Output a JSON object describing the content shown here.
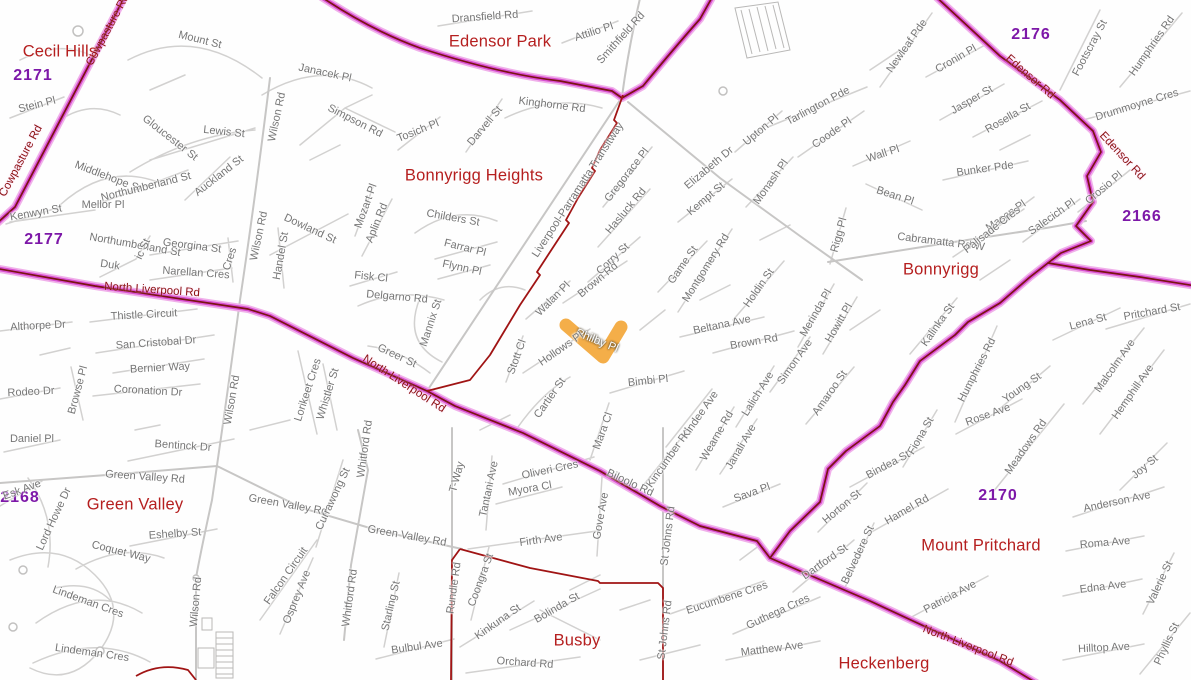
{
  "map": {
    "highlight": {
      "street": "Philby Pl",
      "color": "#f3aa3f"
    },
    "colors": {
      "major_road_halo": "#f0b0ea",
      "major_road": "#d94fd2",
      "major_road_centerline": "#7a1313",
      "boundary_line": "#a01414",
      "minor_road": "#d2d1d0",
      "street_label": "#767676",
      "road_label": "#8b1212",
      "suburb_label": "#b51f1f",
      "postcode_label": "#7d18a8"
    },
    "suburbs": [
      {
        "name": "Cecil Hills",
        "postcode": "2171"
      },
      {
        "name": "Edensor Park",
        "postcode": "2176"
      },
      {
        "name": "Bonnyrigg Heights",
        "postcode": "2177"
      },
      {
        "name": "Bonnyrigg",
        "postcode": "2177"
      },
      {
        "name": "Green Valley",
        "postcode": "2168"
      },
      {
        "name": "Busby",
        "postcode": "2168"
      },
      {
        "name": "Mount Pritchard",
        "postcode": "2170"
      },
      {
        "name": "Heckenberg",
        "postcode": "2168"
      }
    ],
    "labels": [
      [
        "Cecil Hills",
        60,
        52,
        0,
        "u"
      ],
      [
        "Edensor Park",
        500,
        42,
        0,
        "u"
      ],
      [
        "Bonnyrigg Heights",
        474,
        176,
        0,
        "u"
      ],
      [
        "Bonnyrigg",
        941,
        270,
        0,
        "u"
      ],
      [
        "Green Valley",
        135,
        505,
        0,
        "u"
      ],
      [
        "Busby",
        577,
        641,
        0,
        "u"
      ],
      [
        "Mount Pritchard",
        981,
        546,
        0,
        "u"
      ],
      [
        "Heckenberg",
        884,
        664,
        0,
        "u"
      ],
      [
        "2171",
        33,
        76,
        0,
        "p"
      ],
      [
        "2176",
        1031,
        35,
        0,
        "p"
      ],
      [
        "2177",
        44,
        240,
        0,
        "p"
      ],
      [
        "2166",
        1142,
        217,
        0,
        "p"
      ],
      [
        "2168",
        20,
        498,
        0,
        "p"
      ],
      [
        "2170",
        998,
        496,
        0,
        "p"
      ],
      [
        "Cowpasture Rd",
        108,
        30,
        -62,
        "r"
      ],
      [
        "Cowpasture Rd",
        21,
        161,
        -62,
        "r"
      ],
      [
        "North Liverpool Rd",
        152,
        290,
        4,
        "r"
      ],
      [
        "North Liverpool Rd",
        404,
        384,
        33,
        "r"
      ],
      [
        "North Liverpool Rd",
        968,
        646,
        21,
        "r"
      ],
      [
        "Edensor Rd",
        1030,
        77,
        41,
        "r"
      ],
      [
        "Edensor Rd",
        1122,
        156,
        47,
        "r"
      ],
      [
        "Philby Pl",
        597,
        341,
        22,
        "h"
      ],
      [
        "Mount St",
        200,
        40,
        14,
        "s"
      ],
      [
        "Janacek Pl",
        325,
        73,
        12,
        "s"
      ],
      [
        "Stein Pl",
        37,
        105,
        -14,
        "s"
      ],
      [
        "Gloucester St",
        170,
        138,
        38,
        "s"
      ],
      [
        "Lewis St",
        224,
        132,
        6,
        "s"
      ],
      [
        "Wilson Rd",
        277,
        117,
        -78,
        "s"
      ],
      [
        "Simpson Rd",
        355,
        121,
        27,
        "s"
      ],
      [
        "Middlehope St",
        108,
        177,
        21,
        "s"
      ],
      [
        "Northumberland St",
        146,
        187,
        -14,
        "s"
      ],
      [
        "Auckland St",
        219,
        176,
        -38,
        "s"
      ],
      [
        "Mellor Pl",
        103,
        205,
        0,
        "s"
      ],
      [
        "Kenwyn St",
        36,
        213,
        -10,
        "s"
      ],
      [
        "Northumberland St",
        135,
        245,
        10,
        "s"
      ],
      [
        "Georgina St",
        192,
        246,
        7,
        "s"
      ],
      [
        "Duk",
        110,
        265,
        8,
        "s"
      ],
      [
        "ic St",
        143,
        249,
        -65,
        "s"
      ],
      [
        "Narellan Cres",
        196,
        273,
        4,
        "s"
      ],
      [
        "Cres",
        230,
        259,
        -72,
        "s"
      ],
      [
        "Dowland St",
        310,
        229,
        25,
        "s"
      ],
      [
        "Handel St",
        281,
        256,
        -80,
        "s"
      ],
      [
        "Wilson Rd",
        259,
        236,
        -78,
        "s"
      ],
      [
        "Mozart Pl",
        366,
        206,
        -70,
        "s"
      ],
      [
        "Aplin Rd",
        377,
        223,
        -68,
        "s"
      ],
      [
        "Fisk Cl",
        371,
        277,
        6,
        "s"
      ],
      [
        "Delgarno Rd",
        397,
        297,
        5,
        "s"
      ],
      [
        "Childers St",
        453,
        218,
        10,
        "s"
      ],
      [
        "Farrar Pl",
        465,
        248,
        14,
        "s"
      ],
      [
        "Flynn Pl",
        462,
        268,
        12,
        "s"
      ],
      [
        "Mannix St",
        431,
        323,
        -72,
        "s"
      ],
      [
        "Greer St",
        397,
        356,
        25,
        "s"
      ],
      [
        "Tosich Pl",
        418,
        131,
        -22,
        "s"
      ],
      [
        "Darvell St",
        485,
        126,
        -50,
        "s"
      ],
      [
        "Kinghorne Rd",
        552,
        105,
        7,
        "s"
      ],
      [
        "Dransfield Rd",
        485,
        17,
        -4,
        "s"
      ],
      [
        "Attilio Pl",
        594,
        32,
        -18,
        "s"
      ],
      [
        "Smithfield Rd",
        621,
        38,
        -48,
        "s"
      ],
      [
        "Liverpool-Parramatta Transitway",
        578,
        190,
        -57,
        "s"
      ],
      [
        "Upton Pl",
        761,
        130,
        -40,
        "s"
      ],
      [
        "Elizabeth Dr",
        709,
        168,
        -40,
        "s"
      ],
      [
        "Kempt St",
        706,
        199,
        -40,
        "s"
      ],
      [
        "Monash Pl",
        771,
        182,
        -55,
        "s"
      ],
      [
        "Gregorace Pl",
        627,
        175,
        -52,
        "s"
      ],
      [
        "Hasluck Rd",
        626,
        211,
        -50,
        "s"
      ],
      [
        "Corry St",
        613,
        259,
        -43,
        "s"
      ],
      [
        "Brown Rd",
        598,
        280,
        -40,
        "s"
      ],
      [
        "Game St",
        683,
        265,
        -55,
        "s"
      ],
      [
        "Montgomery Rd",
        706,
        268,
        -58,
        "s"
      ],
      [
        "Holdin St",
        759,
        288,
        -55,
        "s"
      ],
      [
        "Beltana Ave",
        722,
        325,
        -12,
        "s"
      ],
      [
        "Brown Rd",
        754,
        342,
        -10,
        "s"
      ],
      [
        "Merinda Pl",
        816,
        313,
        -60,
        "s"
      ],
      [
        "Howitt Pl",
        839,
        323,
        -60,
        "s"
      ],
      [
        "Rigg Pl",
        839,
        235,
        -75,
        "s"
      ],
      [
        "Cabramatta Rd W",
        941,
        242,
        7,
        "s"
      ],
      [
        "Simon Ave",
        795,
        362,
        -55,
        "s"
      ],
      [
        "Amaroo St",
        830,
        393,
        -55,
        "s"
      ],
      [
        "Lalich Ave",
        758,
        394,
        -58,
        "s"
      ],
      [
        "Walan Pl",
        553,
        299,
        -45,
        "s"
      ],
      [
        "Hollows Pl",
        561,
        349,
        -35,
        "s"
      ],
      [
        "Stott Cl",
        517,
        357,
        -70,
        "s"
      ],
      [
        "Cartier St",
        550,
        398,
        -55,
        "s"
      ],
      [
        "Bimbi Pl",
        648,
        381,
        -6,
        "s"
      ],
      [
        "Mara Cl",
        603,
        431,
        -70,
        "s"
      ],
      [
        "Kincumber Rd",
        669,
        458,
        -55,
        "s"
      ],
      [
        "Kindee Ave",
        700,
        415,
        -55,
        "s"
      ],
      [
        "Wearne Rd",
        717,
        436,
        -60,
        "s"
      ],
      [
        "Janali Ave",
        741,
        447,
        -60,
        "s"
      ],
      [
        "Sava Pl",
        752,
        493,
        -20,
        "s"
      ],
      [
        "Tarlington Pde",
        818,
        106,
        -28,
        "s"
      ],
      [
        "Coode Pl",
        832,
        133,
        -35,
        "s"
      ],
      [
        "Wall Pl",
        883,
        154,
        -18,
        "s"
      ],
      [
        "Bean Pl",
        895,
        196,
        18,
        "s"
      ],
      [
        "Newleaf Pde",
        907,
        46,
        -55,
        "s"
      ],
      [
        "Cronin Pl",
        956,
        59,
        -30,
        "s"
      ],
      [
        "Jasper St",
        972,
        100,
        -30,
        "s"
      ],
      [
        "Rosella St",
        1008,
        118,
        -30,
        "s"
      ],
      [
        "Footscray St",
        1090,
        48,
        -62,
        "s"
      ],
      [
        "Humphries Rd",
        1152,
        46,
        -55,
        "s"
      ],
      [
        "Drummoyne Cres",
        1137,
        105,
        -17,
        "s"
      ],
      [
        "Bunker Pde",
        985,
        169,
        -8,
        "s"
      ],
      [
        "Mason Pl",
        1006,
        216,
        -35,
        "s"
      ],
      [
        "Palisade Cres",
        992,
        230,
        -38,
        "s"
      ],
      [
        "Salecich Pl",
        1052,
        217,
        -35,
        "s"
      ],
      [
        "Crosio Pl",
        1104,
        188,
        -40,
        "s"
      ],
      [
        "Pritchard St",
        1152,
        312,
        -10,
        "s"
      ],
      [
        "Lena St",
        1088,
        322,
        -15,
        "s"
      ],
      [
        "Malcolm Ave",
        1115,
        366,
        -55,
        "s"
      ],
      [
        "Hemphill Ave",
        1133,
        392,
        -55,
        "s"
      ],
      [
        "Young St",
        1022,
        388,
        -35,
        "s"
      ],
      [
        "Meadows Rd",
        1026,
        447,
        -55,
        "s"
      ],
      [
        "Rose Ave",
        988,
        415,
        -20,
        "s"
      ],
      [
        "Humphries Rd",
        977,
        370,
        -63,
        "s"
      ],
      [
        "Kalinka St",
        938,
        325,
        -55,
        "s"
      ],
      [
        "Fiona St",
        921,
        436,
        -60,
        "s"
      ],
      [
        "Bindea St",
        888,
        465,
        -28,
        "s"
      ],
      [
        "Horton St",
        842,
        507,
        -40,
        "s"
      ],
      [
        "Hamel Rd",
        907,
        510,
        -30,
        "s"
      ],
      [
        "Dartford St",
        825,
        562,
        -35,
        "s"
      ],
      [
        "Belvedere St",
        858,
        555,
        -65,
        "s"
      ],
      [
        "Anderson Ave",
        1117,
        502,
        -12,
        "s"
      ],
      [
        "Joy St",
        1145,
        467,
        -40,
        "s"
      ],
      [
        "Roma Ave",
        1105,
        543,
        -5,
        "s"
      ],
      [
        "Edna Ave",
        1103,
        587,
        -7,
        "s"
      ],
      [
        "Valerie St",
        1160,
        583,
        -65,
        "s"
      ],
      [
        "Phyllis St",
        1167,
        644,
        -65,
        "s"
      ],
      [
        "Hilltop Ave",
        1104,
        648,
        -3,
        "s"
      ],
      [
        "Patricia Ave",
        950,
        597,
        -28,
        "s"
      ],
      [
        "Guthega Cres",
        778,
        612,
        -25,
        "s"
      ],
      [
        "Matthew Ave",
        772,
        649,
        -7,
        "s"
      ],
      [
        "Eucumbene Cres",
        727,
        598,
        -18,
        "s"
      ],
      [
        "St Johns Rd",
        668,
        536,
        -83,
        "s"
      ],
      [
        "St Johns Rd",
        665,
        630,
        -83,
        "s"
      ],
      [
        "Biloolo Rd",
        630,
        483,
        25,
        "s"
      ],
      [
        "Gove Ave",
        601,
        516,
        -80,
        "s"
      ],
      [
        "Oliveri Cres",
        550,
        470,
        -12,
        "s"
      ],
      [
        "Myora Cl",
        530,
        489,
        -10,
        "s"
      ],
      [
        "Tantani Ave",
        489,
        489,
        -78,
        "s"
      ],
      [
        "Firth Ave",
        541,
        540,
        -8,
        "s"
      ],
      [
        "T-Way",
        457,
        477,
        -75,
        "s"
      ],
      [
        "Rundle Rd",
        454,
        588,
        -82,
        "s"
      ],
      [
        "Coongra St",
        481,
        580,
        -70,
        "s"
      ],
      [
        "Kinkuna St",
        498,
        622,
        -35,
        "s"
      ],
      [
        "Bolinda St",
        557,
        608,
        -30,
        "s"
      ],
      [
        "Orchard Rd",
        525,
        663,
        4,
        "s"
      ],
      [
        "Bulbul Ave",
        417,
        647,
        -8,
        "s"
      ],
      [
        "Green Valley Rd",
        145,
        477,
        4,
        "s"
      ],
      [
        "Green Valley Rd",
        288,
        505,
        10,
        "s"
      ],
      [
        "Green Valley Rd",
        407,
        536,
        10,
        "s"
      ],
      [
        "Bentinck Dr",
        183,
        446,
        4,
        "s"
      ],
      [
        "Daniel Pl",
        32,
        439,
        0,
        "s"
      ],
      [
        "Esk Ave",
        22,
        490,
        -20,
        "s"
      ],
      [
        "Lord Howe Dr",
        54,
        519,
        -65,
        "s"
      ],
      [
        "Eshelby St",
        175,
        534,
        -4,
        "s"
      ],
      [
        "Coquet Way",
        121,
        552,
        14,
        "s"
      ],
      [
        "Lindeman Cres",
        88,
        602,
        20,
        "s"
      ],
      [
        "Lindeman Cres",
        92,
        653,
        8,
        "s"
      ],
      [
        "Falcon Circuit",
        286,
        576,
        -55,
        "s"
      ],
      [
        "Osprey Ave",
        297,
        597,
        -68,
        "s"
      ],
      [
        "Currawong St",
        333,
        499,
        -65,
        "s"
      ],
      [
        "Whitford Rd",
        365,
        449,
        -82,
        "s"
      ],
      [
        "Whitford Rd",
        350,
        598,
        -82,
        "s"
      ],
      [
        "Starling St",
        391,
        606,
        -77,
        "s"
      ],
      [
        "Wilson Rd",
        196,
        602,
        -85,
        "s"
      ],
      [
        "Wilson Rd",
        232,
        400,
        -80,
        "s"
      ],
      [
        "Althorpe Dr",
        38,
        326,
        -3,
        "s"
      ],
      [
        "Thistle Circuit",
        144,
        315,
        -3,
        "s"
      ],
      [
        "San Cristobal Dr",
        156,
        343,
        -4,
        "s"
      ],
      [
        "Bernier Way",
        160,
        368,
        -3,
        "s"
      ],
      [
        "Coronation Dr",
        148,
        391,
        3,
        "s"
      ],
      [
        "Rodeo Dr",
        31,
        392,
        -3,
        "s"
      ],
      [
        "Browse Pl",
        78,
        390,
        -75,
        "s"
      ],
      [
        "Lorikeet Cres",
        308,
        390,
        -72,
        "s"
      ],
      [
        "Whistler St",
        328,
        394,
        -73,
        "s"
      ]
    ]
  }
}
